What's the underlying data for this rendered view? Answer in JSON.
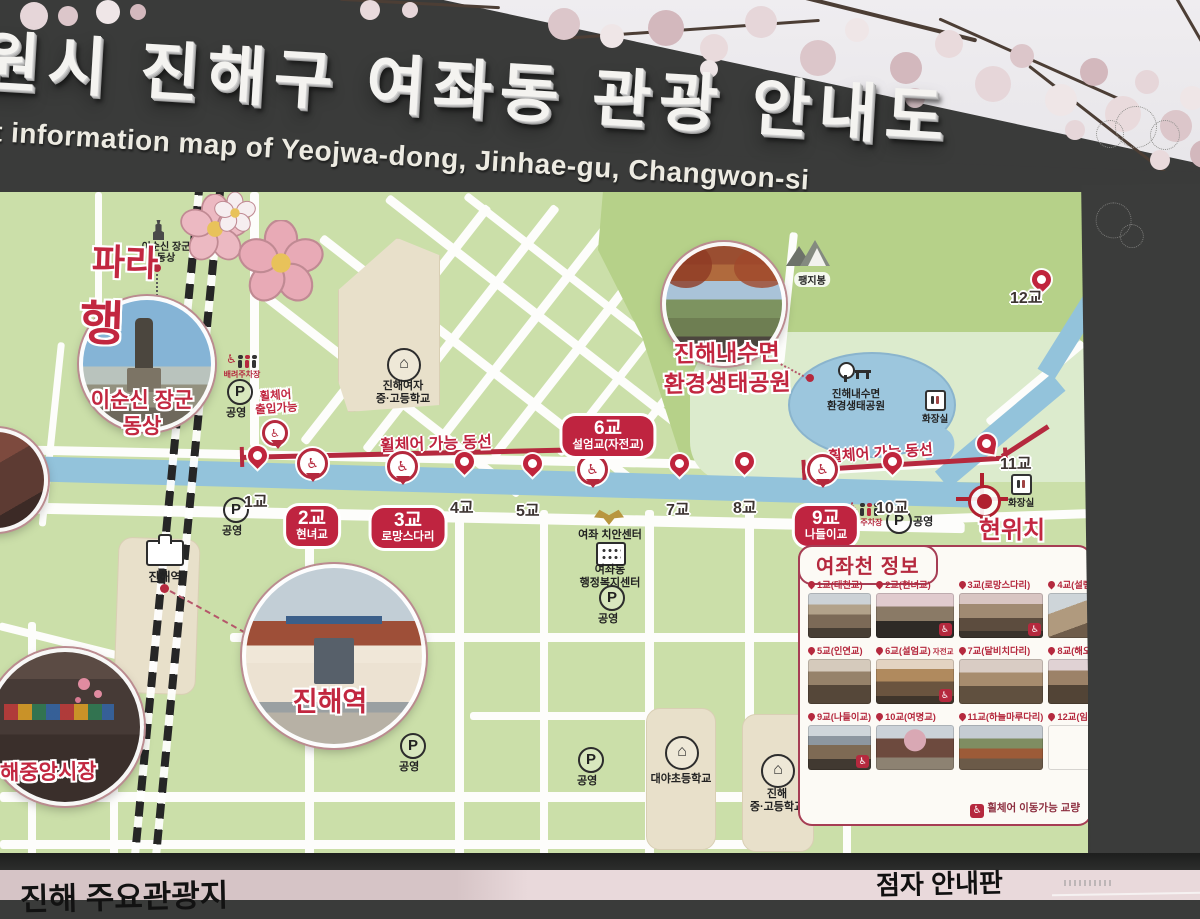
{
  "header": {
    "title_ko": "원시 진해구 여좌동 관광 안내도",
    "subtitle_en": "t information map of Yeojwa-dong, Jinhae-gu, Changwon-si"
  },
  "slogan": {
    "fragment1": "파라",
    "fragment2": "행"
  },
  "colors": {
    "accent_red": "#b5293e",
    "badge_red": "#bf2440",
    "map_green": "#cbdfa9",
    "stream_blue": "#93c3db",
    "board_dark": "#3a3b3a"
  },
  "map": {
    "statue": {
      "icon_label": [
        "이순신 장군",
        "동상"
      ],
      "photo_label": [
        "이순신 장군",
        "동상"
      ]
    },
    "station": {
      "map_label": "진해역",
      "photo_label": "진해역"
    },
    "market": {
      "photo_label": "해중앙시장"
    },
    "eco_park": {
      "photo_label": [
        "진해내수면",
        "환경생태공원"
      ],
      "map_label": [
        "진해내수면",
        "환경생태공원"
      ]
    },
    "peak_label": "팽지봉",
    "girls_school_label": [
      "진해여자",
      "중·고등학교"
    ],
    "police_label": "여좌 치안센터",
    "admin_center_label": [
      "여좌동",
      "행정복지센터"
    ],
    "daeya_school_label": "대야초등학교",
    "jinhae_school_label": [
      "진해",
      "중·고등학교"
    ],
    "public_parking_label": "공영",
    "care_parking_label": "배려주차장",
    "restroom_label": "화장실",
    "wheelchair_entry_label": [
      "휠체어",
      "출입가능"
    ],
    "route_label": "휠체어 가능 동선",
    "current_location_label": "현위치",
    "bridges": [
      {
        "label": "1교"
      },
      {
        "label": "2교",
        "name": "현녀교",
        "wheelchair": true
      },
      {
        "label": "3교",
        "name": "로망스다리",
        "wheelchair": true
      },
      {
        "label": "4교"
      },
      {
        "label": "5교"
      },
      {
        "label": "6교",
        "name": "설엄교(자전교)",
        "wheelchair": true
      },
      {
        "label": "7교"
      },
      {
        "label": "8교"
      },
      {
        "label": "9교",
        "name": "나들이교",
        "wheelchair": true
      },
      {
        "label": "10교"
      },
      {
        "label": "11교"
      },
      {
        "label": "12교"
      }
    ]
  },
  "legend": {
    "title": "여좌천 정보",
    "items": [
      {
        "label": "1교(대천교)"
      },
      {
        "label": "2교(현녀교)",
        "wheelchair": true
      },
      {
        "label": "3교(로망스다리)",
        "wheelchair": true
      },
      {
        "label": "4교(설렘교)"
      },
      {
        "label": "5교(인연교)"
      },
      {
        "label": "6교(설엄교)",
        "suffix": "자전교",
        "wheelchair": true
      },
      {
        "label": "7교(달비치다리)"
      },
      {
        "label": "8교(해오름다리)"
      },
      {
        "label": "9교(나들이교)",
        "wheelchair": true
      },
      {
        "label": "10교(여명교)"
      },
      {
        "label": "11교(하늘마루다리)"
      },
      {
        "label": "12교(임지교)"
      }
    ],
    "note": "휠체어 이동가능 교량"
  },
  "footer": {
    "left_label": "진해 주요관광지",
    "right_label": "점자 안내판"
  }
}
